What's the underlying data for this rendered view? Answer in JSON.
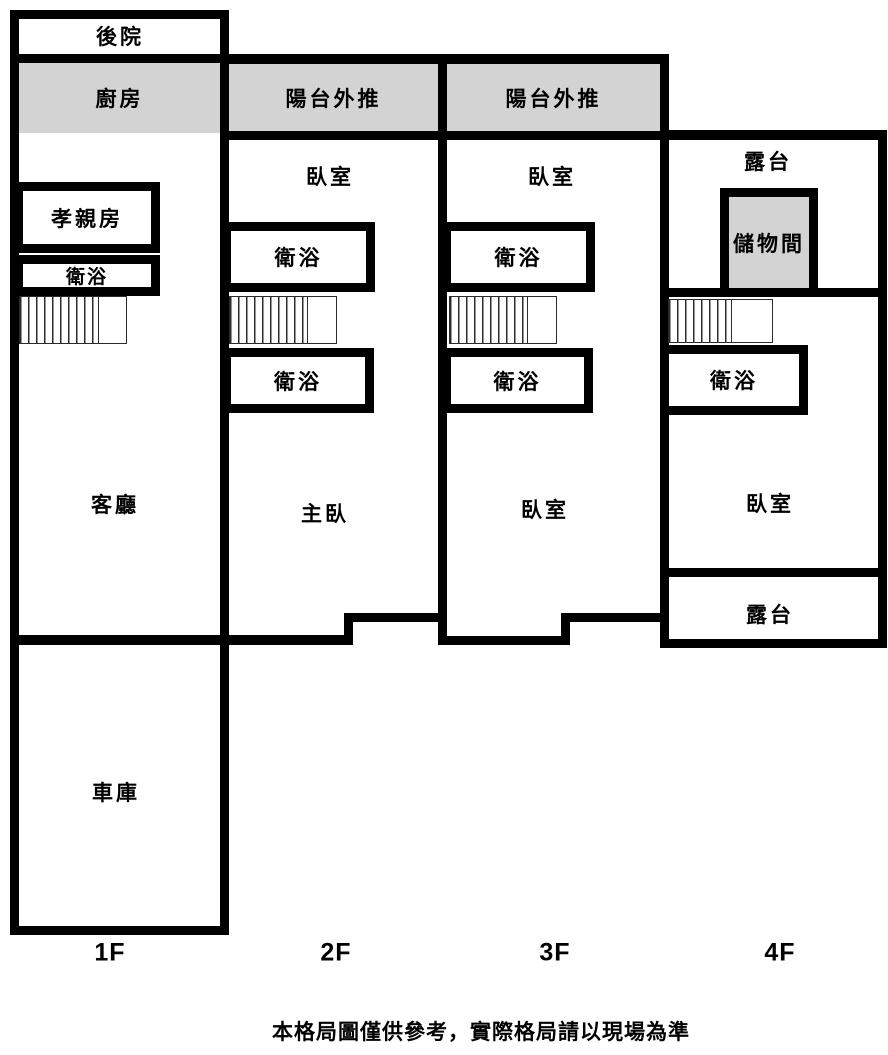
{
  "floors": {
    "f1": {
      "floor_label": "1F",
      "backyard": "後院",
      "kitchen": "廚房",
      "parents_room": "孝親房",
      "bathroom": "衛浴",
      "living_room": "客廳",
      "garage": "車庫"
    },
    "f2": {
      "floor_label": "2F",
      "balcony_extension": "陽台外推",
      "bedroom": "臥室",
      "bathroom_upper": "衛浴",
      "bathroom_lower": "衛浴",
      "master_bedroom": "主臥"
    },
    "f3": {
      "floor_label": "3F",
      "balcony_extension": "陽台外推",
      "bedroom_upper": "臥室",
      "bathroom_upper": "衛浴",
      "bathroom_lower": "衛浴",
      "bedroom_lower": "臥室"
    },
    "f4": {
      "floor_label": "4F",
      "terrace_upper": "露台",
      "storage_room": "儲物間",
      "bathroom": "衛浴",
      "bedroom": "臥室",
      "terrace_lower": "露台"
    },
    "disclaimer": "本格局圖僅供參考，實際格局請以現場為準"
  },
  "colors": {
    "wall": "#000000",
    "highlight_fill": "#d3d3d3",
    "background": "#ffffff",
    "stair_line": "#2b2b2b"
  }
}
